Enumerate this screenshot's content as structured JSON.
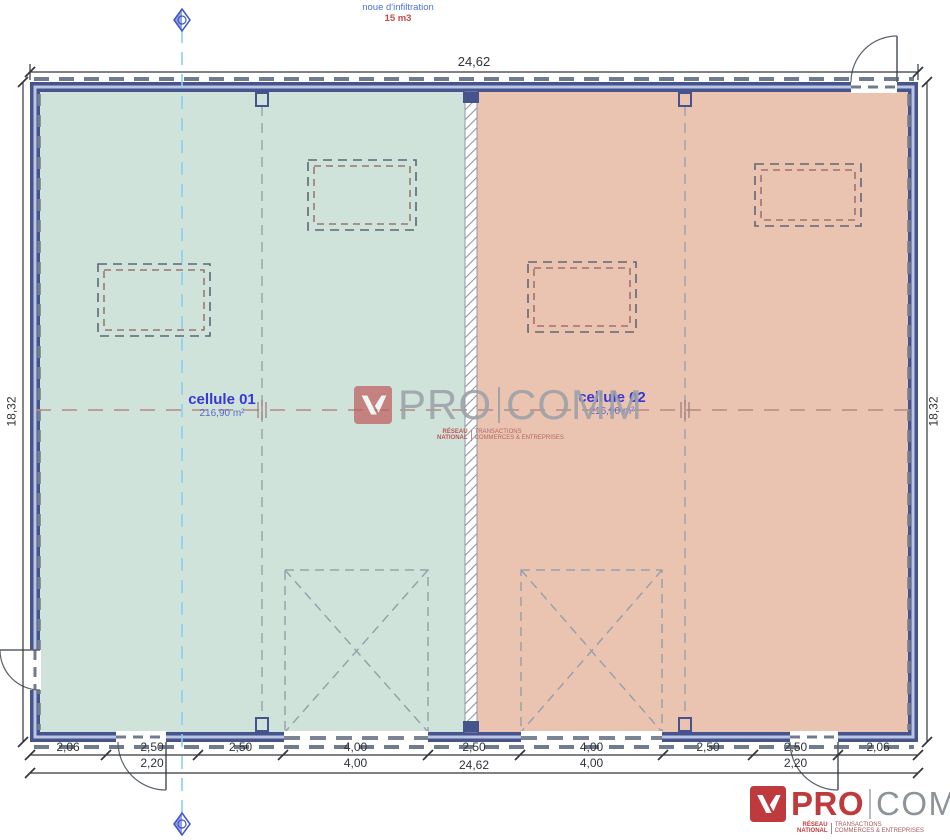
{
  "note": {
    "line1": "noue d'infiltration",
    "line2": "15 m3"
  },
  "cells": [
    {
      "label": "cellule 01",
      "area": "216,90 m²",
      "fill": "#cfe3da"
    },
    {
      "label": "cellule 02",
      "area": "216,90 m²",
      "fill": "#eac4b1"
    }
  ],
  "dims": {
    "top_total": "24,62",
    "bottom_total": "24,62",
    "left_height": "18,32",
    "right_height": "18,32",
    "segments": [
      {
        "main": "2,06",
        "sub": ""
      },
      {
        "main": "2,50",
        "sub": "2,20"
      },
      {
        "main": "2,50",
        "sub": ""
      },
      {
        "main": "4,00",
        "sub": "4,00"
      },
      {
        "main": "2,50",
        "sub": ""
      },
      {
        "main": "4,00",
        "sub": "4,00"
      },
      {
        "main": "2,50",
        "sub": ""
      },
      {
        "main": "2,50",
        "sub": "2,20"
      },
      {
        "main": "2,06",
        "sub": ""
      }
    ]
  },
  "watermark": {
    "pro": "PRO",
    "comm": "COMM",
    "tag_left_1": "RÉSEAU",
    "tag_left_2": "NATIONAL",
    "tag_right_1": "TRANSACTIONS",
    "tag_right_2": "COMMERCES & ENTREPRISES"
  },
  "logo": {
    "pro": "PRO",
    "comm": "COMM",
    "tag_left_1": "RÉSEAU",
    "tag_left_2": "NATIONAL",
    "tag_right_1": "TRANSACTIONS",
    "tag_right_2": "COMMERCES & ENTREPRISES"
  },
  "colors": {
    "wall_navy": "#46548e",
    "wall_core": "#bcc5e2",
    "cell1_green": "#cfe3da",
    "cell2_salmon": "#eac4b1",
    "centerline_red": "#b98884",
    "axis_blue": "#8ecdf4",
    "label_blue": "#3837d6",
    "logo_red": "#bf3a3c",
    "logo_gray": "#8d939b"
  }
}
